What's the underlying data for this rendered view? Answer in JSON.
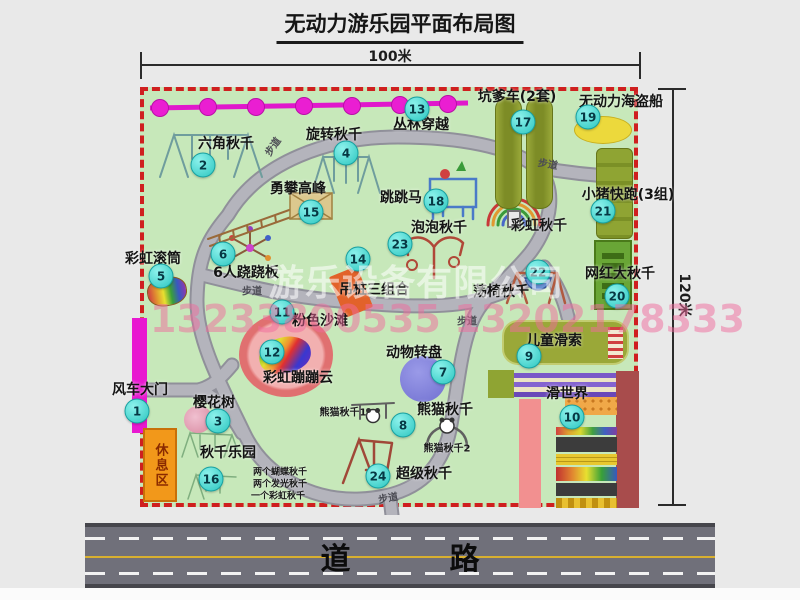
{
  "title": "无动力游乐园平面布局图",
  "dimensions": {
    "width_label": "100米",
    "height_label": "120米"
  },
  "road_label": "道  路",
  "rest_area_label": "休息区",
  "watermark": {
    "company": "游乐设备有限公司",
    "phone": "13233800535 13202178333"
  },
  "colors": {
    "map_green": "#c7e8ba",
    "border_red": "#cf1f1f",
    "badge_cyan": "#2cc6c0",
    "zipline_magenta": "#e018cc",
    "gate_magenta": "#e818d0",
    "rest_orange": "#f2981a",
    "road_gray": "#70707a",
    "walkway_gray": "#a8a8b0"
  },
  "pois": [
    {
      "num": 1,
      "label": "风车大门",
      "bx": 137,
      "by": 411,
      "lx": 140,
      "ly": 389
    },
    {
      "num": 2,
      "label": "六角秋千",
      "bx": 203,
      "by": 165,
      "lx": 226,
      "ly": 143
    },
    {
      "num": 3,
      "label": "樱花树",
      "bx": 218,
      "by": 421,
      "lx": 214,
      "ly": 402
    },
    {
      "num": 4,
      "label": "旋转秋千",
      "bx": 346,
      "by": 153,
      "lx": 334,
      "ly": 134
    },
    {
      "num": 5,
      "label": "彩虹滚筒",
      "bx": 161,
      "by": 276,
      "lx": 153,
      "ly": 258
    },
    {
      "num": 6,
      "label": "6人跷跷板",
      "bx": 223,
      "by": 254,
      "lx": 246,
      "ly": 272
    },
    {
      "num": 7,
      "label": "动物转盘",
      "bx": 443,
      "by": 372,
      "lx": 414,
      "ly": 352
    },
    {
      "num": 8,
      "label": "熊猫秋千",
      "bx": 403,
      "by": 425,
      "lx": 445,
      "ly": 409
    },
    {
      "num": 9,
      "label": "儿童滑索",
      "bx": 529,
      "by": 356,
      "lx": 554,
      "ly": 340
    },
    {
      "num": 10,
      "label": "滑世界",
      "bx": 572,
      "by": 417,
      "lx": 567,
      "ly": 393
    },
    {
      "num": 11,
      "label": "粉色沙滩",
      "bx": 282,
      "by": 312,
      "lx": 320,
      "ly": 320
    },
    {
      "num": 12,
      "label": "彩虹蹦蹦云",
      "bx": 272,
      "by": 352,
      "lx": 298,
      "ly": 377
    },
    {
      "num": 13,
      "label": "丛林穿越",
      "bx": 417,
      "by": 109,
      "lx": 421,
      "ly": 124
    },
    {
      "num": 14,
      "label": "吊桩三组合",
      "bx": 358,
      "by": 259,
      "lx": 374,
      "ly": 289
    },
    {
      "num": 15,
      "label": "勇攀高峰",
      "bx": 311,
      "by": 212,
      "lx": 298,
      "ly": 188
    },
    {
      "num": 16,
      "label": "秋千乐园",
      "bx": 211,
      "by": 479,
      "lx": 228,
      "ly": 452
    },
    {
      "num": 17,
      "label": "坑爹车(2套)",
      "bx": 523,
      "by": 122,
      "lx": 517,
      "ly": 96
    },
    {
      "num": 18,
      "label": "跳跳马",
      "bx": 436,
      "by": 201,
      "lx": 401,
      "ly": 197
    },
    {
      "num": 19,
      "label": "无动力海盗船",
      "bx": 588,
      "by": 117,
      "lx": 621,
      "ly": 101
    },
    {
      "num": 20,
      "label": "网红大秋千",
      "bx": 617,
      "by": 296,
      "lx": 620,
      "ly": 273
    },
    {
      "num": 21,
      "label": "小猪快跑(3组)",
      "bx": 603,
      "by": 211,
      "lx": 628,
      "ly": 194
    },
    {
      "num": 22,
      "label": "荡椅秋千",
      "bx": 538,
      "by": 272,
      "lx": 501,
      "ly": 291
    },
    {
      "num": 23,
      "label": "泡泡秋千",
      "bx": 400,
      "by": 244,
      "lx": 439,
      "ly": 227
    },
    {
      "num": 24,
      "label": "超级秋千",
      "bx": 378,
      "by": 476,
      "lx": 424,
      "ly": 473
    }
  ],
  "extra_labels": [
    {
      "text": "彩虹秋千",
      "x": 539,
      "y": 225,
      "size": 14
    },
    {
      "text": "熊猫秋千1",
      "x": 343,
      "y": 411,
      "size": 10
    },
    {
      "text": "熊猫秋千2",
      "x": 447,
      "y": 447,
      "size": 10
    },
    {
      "text": "两个蝴蝶秋千",
      "x": 280,
      "y": 471,
      "size": 9
    },
    {
      "text": "两个发光秋千",
      "x": 280,
      "y": 483,
      "size": 9
    },
    {
      "text": "一个彩虹秋千",
      "x": 278,
      "y": 495,
      "size": 9
    }
  ],
  "path_labels": [
    {
      "text": "步道",
      "x": 272,
      "y": 146,
      "rot": -55
    },
    {
      "text": "步道",
      "x": 548,
      "y": 163,
      "rot": 10
    },
    {
      "text": "步道",
      "x": 252,
      "y": 290,
      "rot": 0
    },
    {
      "text": "步道",
      "x": 467,
      "y": 320,
      "rot": 0
    },
    {
      "text": "步道",
      "x": 388,
      "y": 497,
      "rot": -10
    }
  ]
}
